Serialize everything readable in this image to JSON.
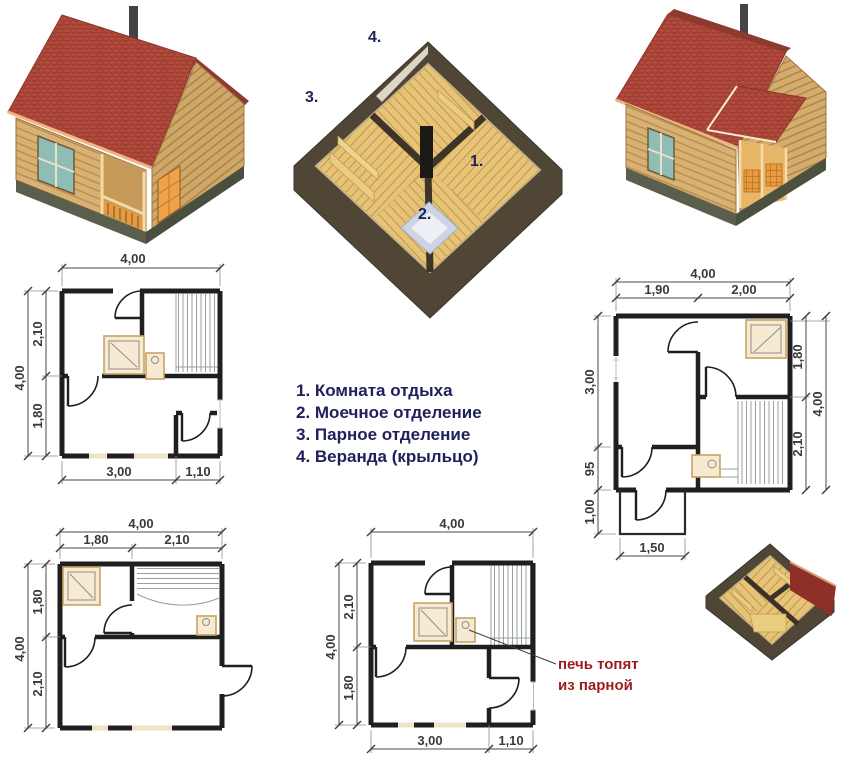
{
  "colors": {
    "roof_red": "#b24a3c",
    "roof_shadow": "#8d3a30",
    "log_wood": "#d9b273",
    "window_teal": "#8fbcb4",
    "legend_navy": "#20205c",
    "note_red": "#9b1c1c",
    "floor_wood": "#e6c377",
    "cutaway_wall": "#4f4636",
    "plan_wall": "#1f1f1f",
    "fixture_beige": "#f6ead0",
    "foundation": "#5a5e4c"
  },
  "legend": {
    "items": [
      "1. Комната отдыха",
      "2. Моечное отделение",
      "3. Парное отделение",
      "4. Веранда (крыльцо)"
    ]
  },
  "cutaway_labels": {
    "rest_room": "1.",
    "wash_room": "2.",
    "steam_room": "3.",
    "veranda": "4."
  },
  "plans": {
    "p1": {
      "top": "4,00",
      "left_outer": "4,00",
      "left_top": "2,10",
      "left_bottom": "1,80",
      "bottom_left": "3,00",
      "bottom_right": "1,10"
    },
    "p2": {
      "top_total": "4,00",
      "top_left": "1,90",
      "top_right": "2,00",
      "left_top": "3,00",
      "left_mid": "95",
      "left_bottom": "1,00",
      "right_top": "1,80",
      "right_outer": "4,00",
      "right_bottom": "2,10",
      "porch": "1,50"
    },
    "p3": {
      "top_total": "4,00",
      "top_left": "1,80",
      "top_right": "2,10",
      "left_top": "1,80",
      "left_outer": "4,00",
      "left_bottom": "2,10"
    },
    "p4": {
      "top": "4,00",
      "left_top": "2,10",
      "left_outer": "4,00",
      "left_bottom": "1,80",
      "bottom_left": "3,00",
      "bottom_right": "1,10"
    }
  },
  "stove_note": {
    "line1": "печь топят",
    "line2": "из парной"
  }
}
